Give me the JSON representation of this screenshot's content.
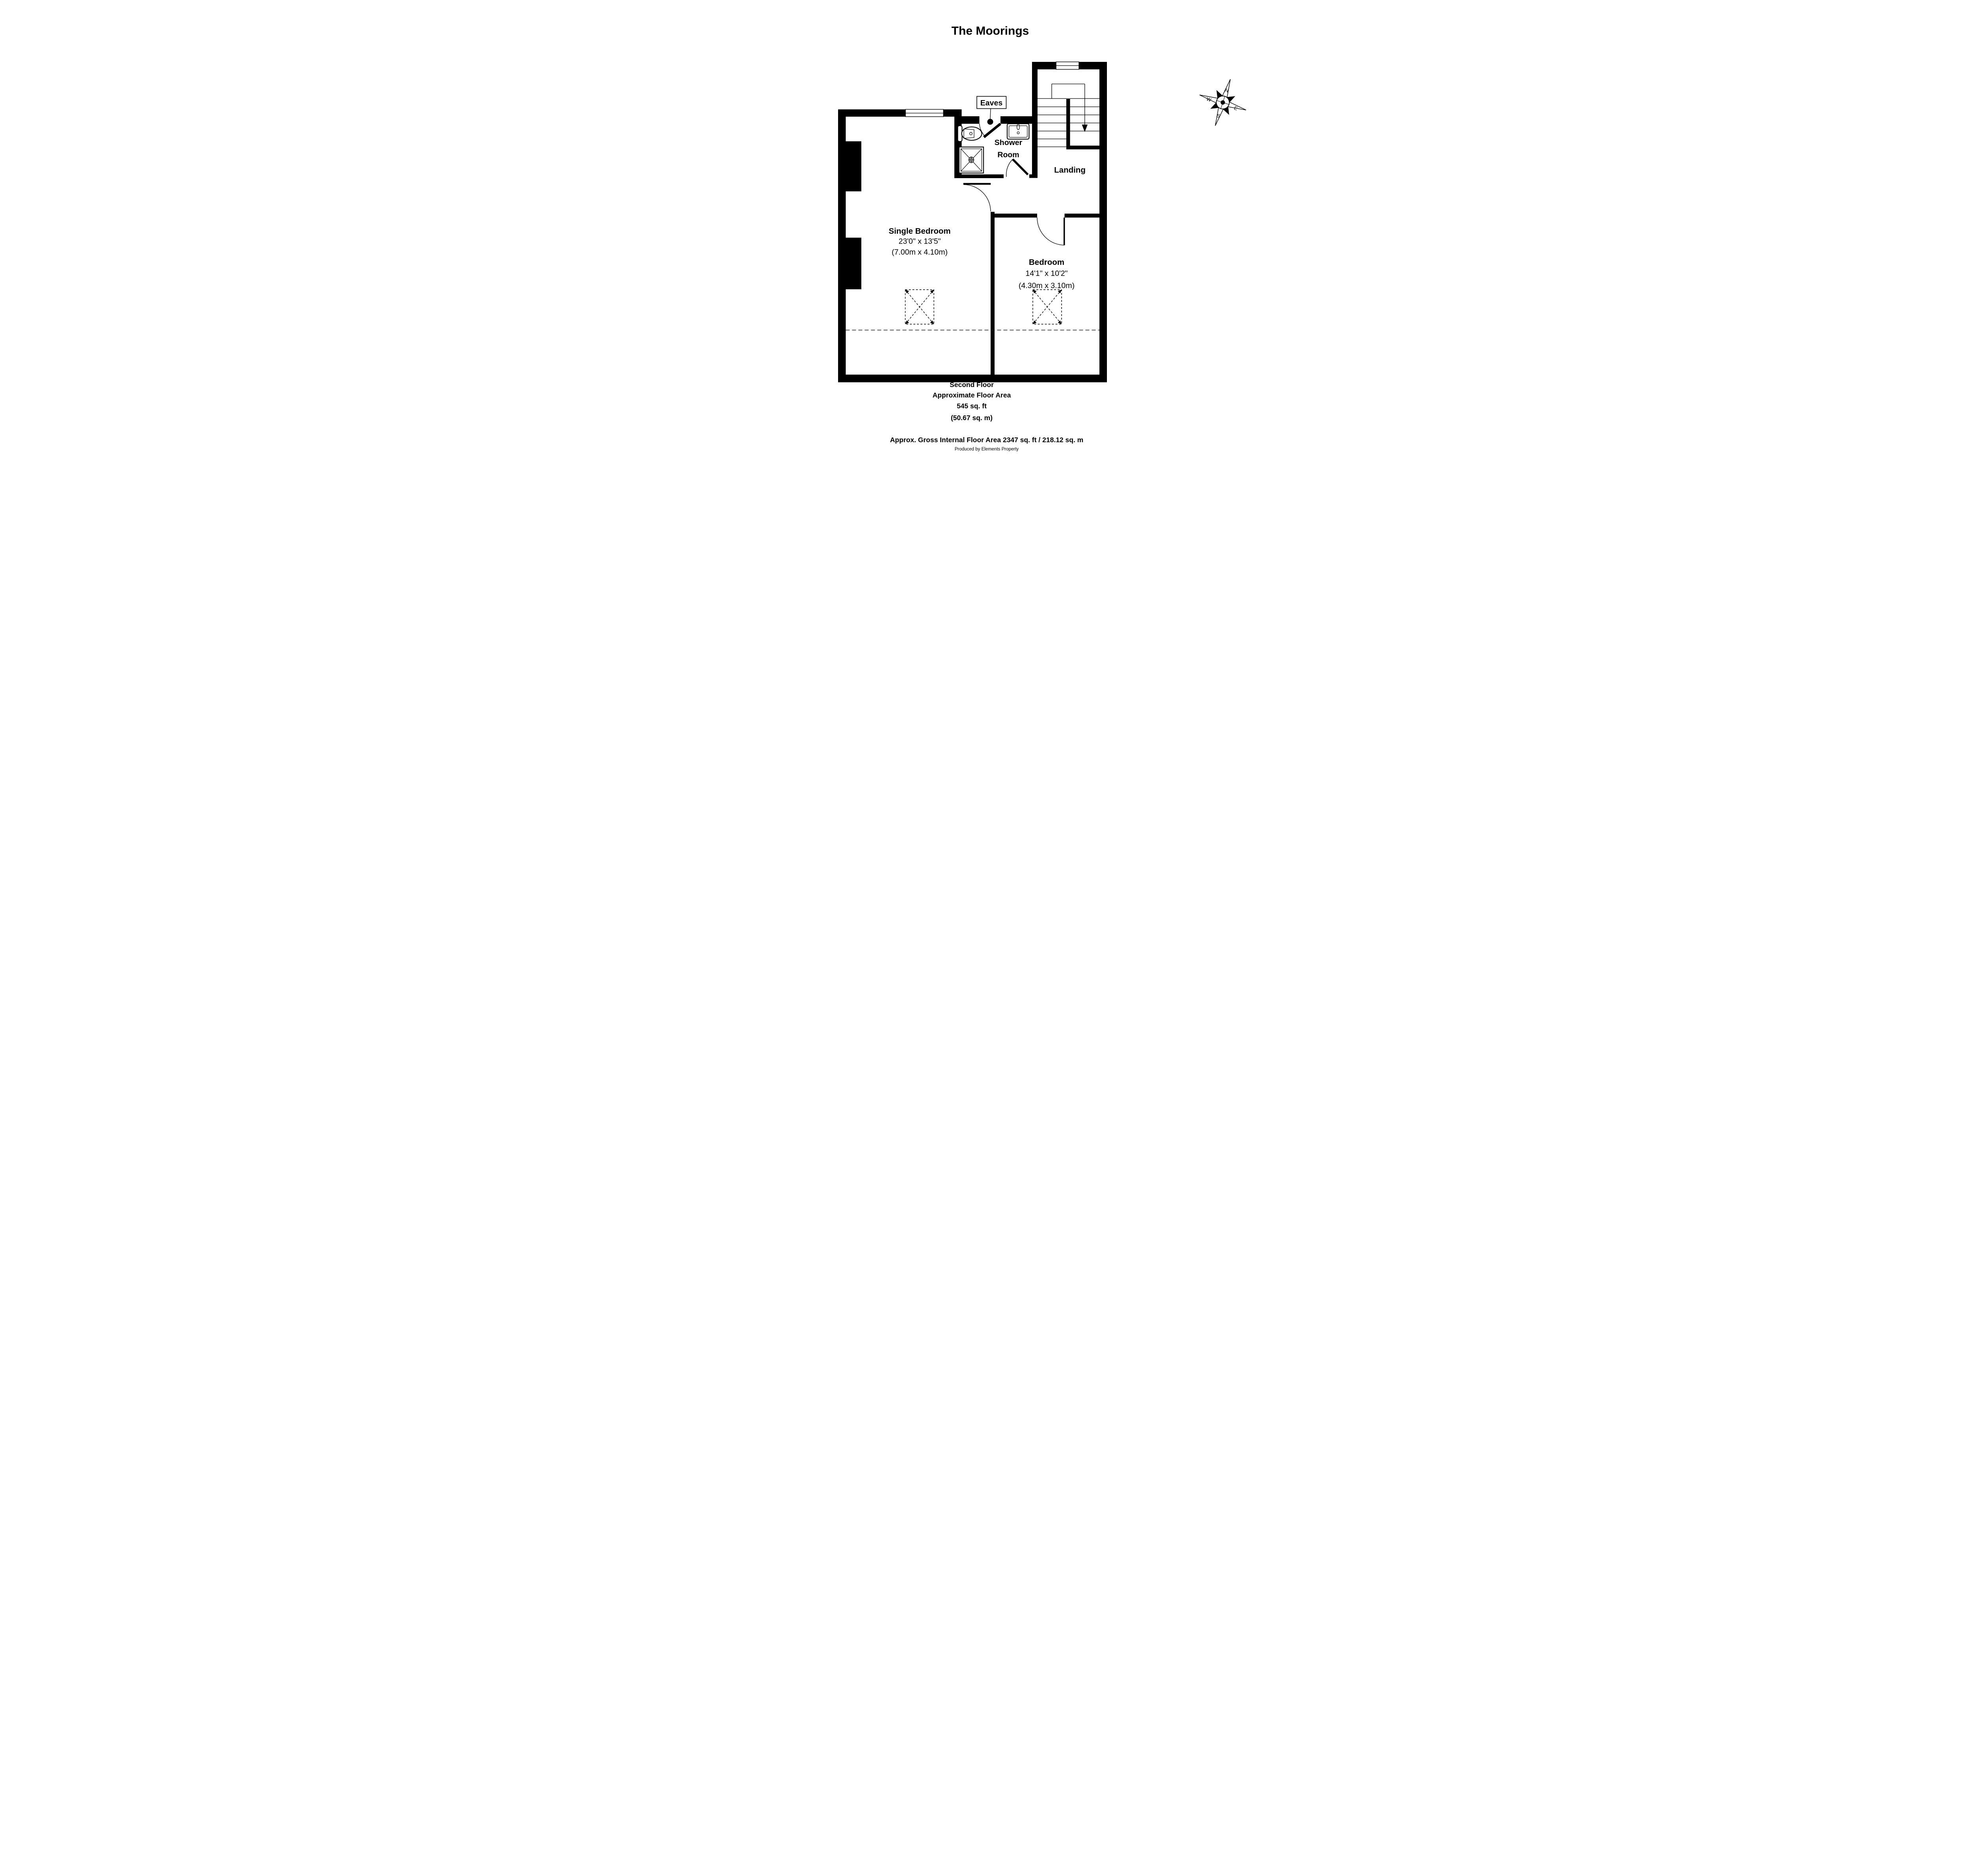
{
  "title": "The Moorings",
  "plan": {
    "labels": {
      "eaves": "Eaves",
      "shower_room_line1": "Shower",
      "shower_room_line2": "Room",
      "landing": "Landing"
    },
    "rooms": [
      {
        "name": "Single Bedroom",
        "dims_imperial": "23'0\" x 13'5\"",
        "dims_metric": "(7.00m x 4.10m)"
      },
      {
        "name": "Bedroom",
        "dims_imperial": "14'1\" x 10'2\"",
        "dims_metric": "(4.30m x 3.10m)"
      }
    ]
  },
  "compass": {
    "north": "N",
    "east": "E",
    "south": "S",
    "west": "W",
    "rotation_deg": 18
  },
  "footer": {
    "floor_name": "Second Floor",
    "area_label": "Approximate Floor Area",
    "area_imperial": "545 sq. ft",
    "area_metric": "(50.67 sq. m)",
    "gross_area": "Approx. Gross Internal Floor Area 2347 sq. ft / 218.12 sq. m",
    "produced_by": "Produced by Elements Property"
  },
  "colors": {
    "wall": "#000000",
    "background": "#ffffff"
  }
}
